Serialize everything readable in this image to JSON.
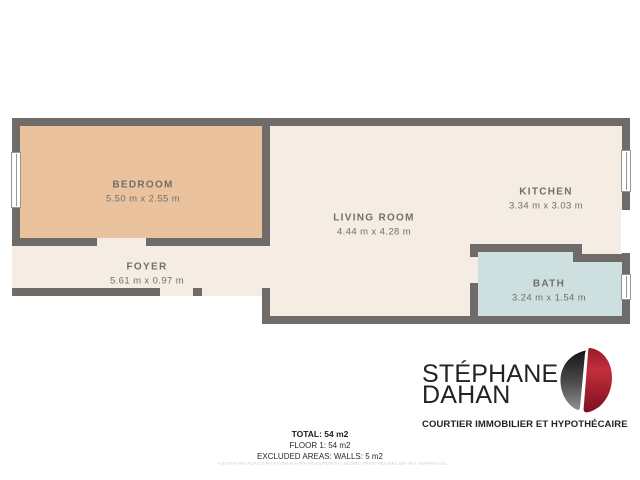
{
  "plan": {
    "rooms": [
      {
        "name": "BEDROOM",
        "dims": "5.50 m x 2.55 m"
      },
      {
        "name": "LIVING ROOM",
        "dims": "4.44 m x 4.28 m"
      },
      {
        "name": "KITCHEN",
        "dims": "3.34 m x 3.03 m"
      },
      {
        "name": "FOYER",
        "dims": "5.61 m x 0.97 m"
      },
      {
        "name": "BATH",
        "dims": "3.24 m x 1.54 m"
      }
    ],
    "colors": {
      "wall": "#6e6b68",
      "bedroom_floor": "#eac39e",
      "main_floor": "#f5ece4",
      "bath_floor": "#cedfdf",
      "label_text": "#716e6b"
    }
  },
  "branding": {
    "name_line1": "STÉPHANE",
    "name_line2": "DAHAN",
    "tagline": "COURTIER IMMOBILIER ET HYPOTHÉCAIRE",
    "logo_mark": "double-d-monogram",
    "colors": {
      "text": "#262122",
      "mark_dark": "#2a2a2a",
      "mark_red": "#b5222f"
    }
  },
  "summary": {
    "total": "TOTAL: 54 m2",
    "floor": "FLOOR 1: 54 m2",
    "excluded": "EXCLUDED AREAS: WALLS: 5 m2",
    "disclaimer": "FLOOR PLAN CREATED WITH CUBICASA APP, MEASUREMENTS DEEMED HIGHLY RELIABLE BUT NOT GUARANTEED."
  }
}
